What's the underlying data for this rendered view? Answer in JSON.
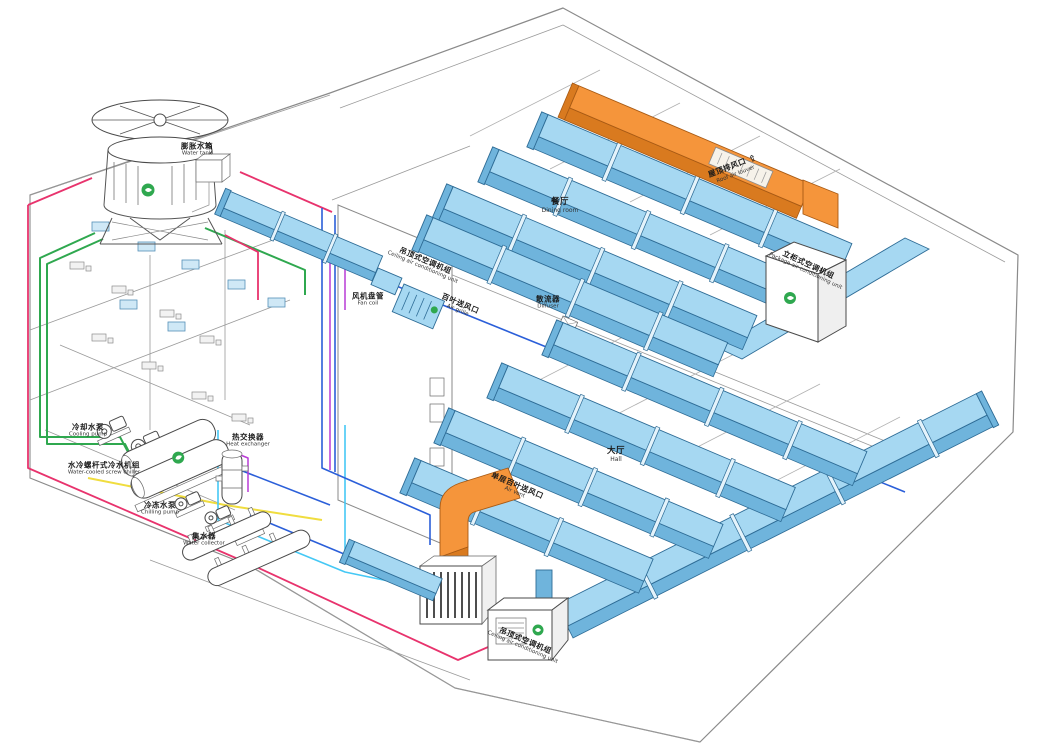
{
  "diagram_type": "central-air-conditioning-system-cutaway",
  "colors": {
    "duct_blue_top": "#a6d8f2",
    "duct_blue_side": "#6fb4dc",
    "duct_outline": "#2e6c96",
    "duct_orange_top": "#f5953b",
    "duct_orange_side": "#d97a1f",
    "duct_orange_edge": "#a85a14",
    "pipe_green": "#2fa84f",
    "pipe_red": "#e8336d",
    "pipe_blue": "#2b5fd9",
    "pipe_cyan": "#45c8f5",
    "pipe_yellow": "#f0dd3f",
    "pipe_magenta": "#b93bd6",
    "logo_green": "#2fa84f"
  },
  "icons": {
    "up_arrow": "⇧"
  },
  "labels": {
    "water_tank": {
      "zh": "膨胀水箱",
      "en": "Water tank"
    },
    "cooling_pump": {
      "zh": "冷却水泵",
      "en": "Cooling pump"
    },
    "chiller": {
      "zh": "水冷螺杆式冷水机组",
      "en": "Water-cooled screw chiller"
    },
    "heat_exchanger": {
      "zh": "热交换器",
      "en": "Heat exchanger"
    },
    "chilling_pump": {
      "zh": "冷冻水泵",
      "en": "Chilling pump"
    },
    "water_collector": {
      "zh": "集水器",
      "en": "Water collector"
    },
    "ceiling_ahu_top": {
      "zh": "吊顶式空调机组",
      "en": "Ceiling air conditioning unit"
    },
    "fan_coil": {
      "zh": "风机盘管",
      "en": "Fan coil"
    },
    "air_grille": {
      "zh": "百叶送风口",
      "en": "Air grille"
    },
    "dining_room": {
      "zh": "餐厅",
      "en": "Dining room"
    },
    "diffuser": {
      "zh": "散流器",
      "en": "Diffuser"
    },
    "return_louver": {
      "zh": "屋顶排风口",
      "en": "Roof air louver"
    },
    "package_ahu": {
      "zh": "立柜式空调机组",
      "en": "Package air conditioning unit"
    },
    "hall": {
      "zh": "大厅",
      "en": "Hall"
    },
    "air_vent": {
      "zh": "单层百叶送风口",
      "en": "Air vent"
    },
    "ceiling_ahu_bottom": {
      "zh": "吊顶式空调机组",
      "en": "Ceiling air conditioning unit"
    }
  }
}
